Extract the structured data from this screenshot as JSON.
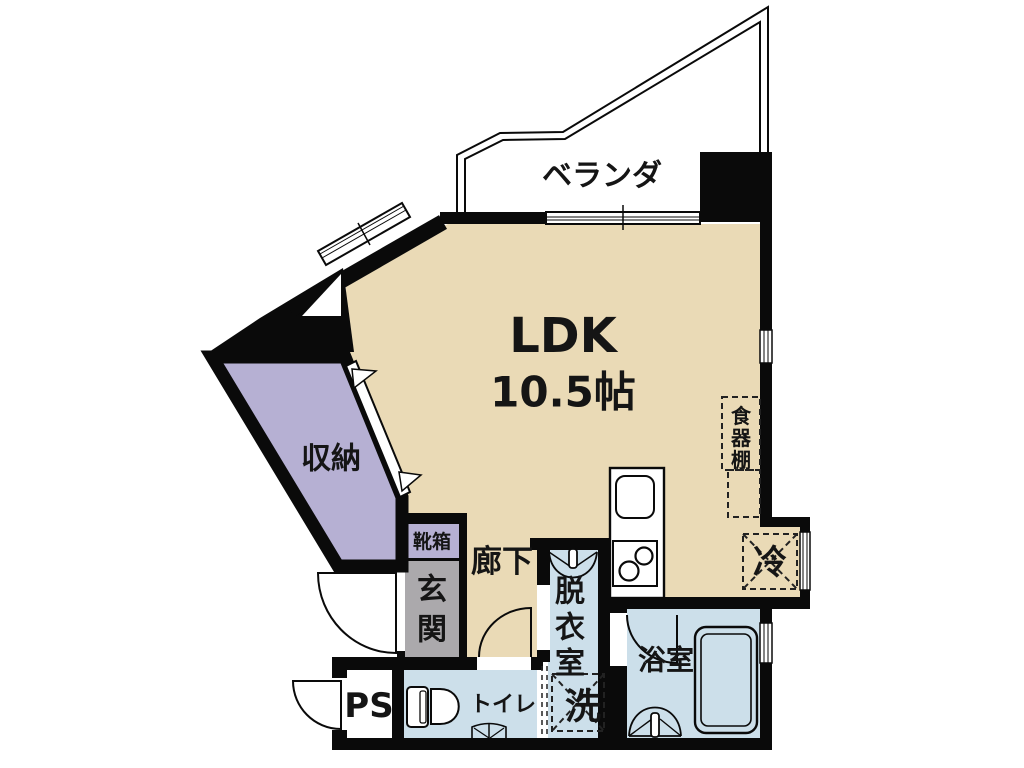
{
  "plan": {
    "type": "apartment-floor-plan",
    "colors": {
      "wall": "#0a0a0a",
      "ldk_floor": "#EADAB6",
      "storage_fill": "#B6B0D3",
      "shoebox_fill": "#B6B0D3",
      "entrance_fill": "#ABA9AC",
      "wet_area_fill": "#CCDFEA",
      "background": "#FFFFFF"
    },
    "rooms": {
      "veranda": {
        "label": "ベランダ"
      },
      "ldk": {
        "name": "LDK",
        "size": "10.5帖"
      },
      "storage": {
        "label": "収納"
      },
      "shoebox": {
        "label": "靴箱"
      },
      "entrance": {
        "chars": [
          "玄",
          "関"
        ]
      },
      "hallway": {
        "label": "廊下"
      },
      "dressing_room": {
        "chars": [
          "脱",
          "衣",
          "室"
        ]
      },
      "washer": {
        "label": "洗"
      },
      "bathroom": {
        "label": "浴室"
      },
      "toilet": {
        "label": "トイレ"
      },
      "pipe_space": {
        "label": "PS"
      },
      "refrigerator": {
        "label": "冷"
      },
      "cupboard": {
        "chars": [
          "食",
          "器",
          "棚"
        ]
      }
    }
  }
}
